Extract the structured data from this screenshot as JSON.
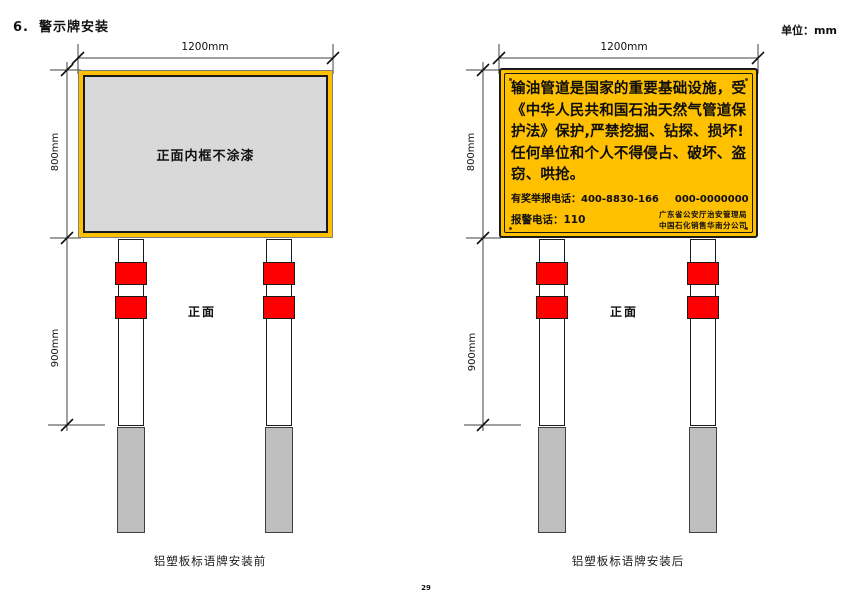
{
  "page": {
    "heading_number": "6.",
    "heading_title": "警示牌安装",
    "units_label": "单位：mm",
    "page_number": "29"
  },
  "colors": {
    "sign_yellow": "#FFC000",
    "panel_gray": "#D9D9D9",
    "band_red": "#FF0000",
    "footing_gray": "#BFBFBF",
    "line": "#404040"
  },
  "left_diagram": {
    "width_dim": "1200mm",
    "height_dim": "800mm",
    "post_dim": "900mm",
    "panel_label": "正面内框不涂漆",
    "front_label": "正面",
    "caption": "铝塑板标语牌安装前"
  },
  "right_diagram": {
    "width_dim": "1200mm",
    "height_dim": "800mm",
    "post_dim": "900mm",
    "front_label": "正面",
    "caption": "铝塑板标语牌安装后",
    "sign": {
      "lines": [
        "输油管道是国家的重要基础设施，受",
        "《中华人民共和国石油天然气管道保",
        "护法》保护,严禁挖掘、钻探、损坏!",
        "任何单位和个人不得侵占、破坏、盗",
        "窃、哄抢。"
      ],
      "hotline": "有奖举报电话：400-8830-166",
      "hotline_alt": "000-0000000",
      "police": "报警电话：110",
      "org_line1": "广东省公安厅治安管理局",
      "org_line2": "中国石化销售华南分公司"
    }
  }
}
